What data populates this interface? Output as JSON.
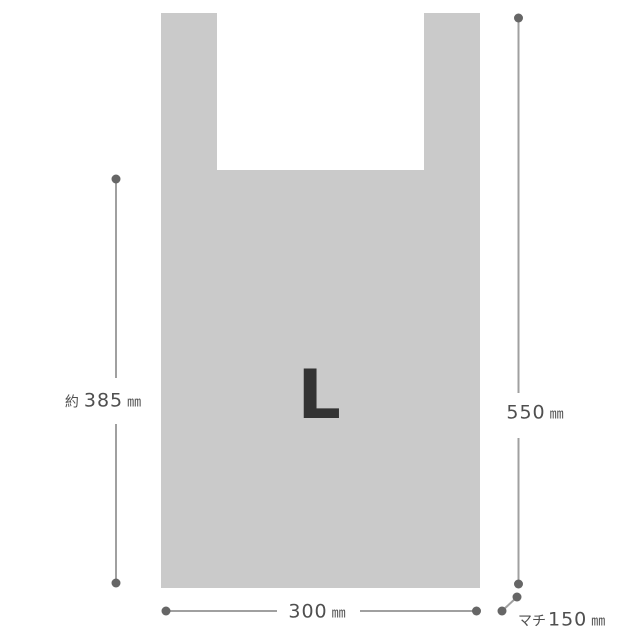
{
  "diagram": {
    "type": "product-dimension-diagram",
    "subject": "vest-type plastic shopping bag",
    "bag": {
      "size_label": "L",
      "fill_color": "#cacaca",
      "size_label_color": "#333333"
    },
    "colors": {
      "line": "#a0a0a0",
      "dot": "#666666",
      "text": "#4f4f4f",
      "background": "#ffffff"
    },
    "dimensions": {
      "left_height": {
        "prefix": "約",
        "value": "385",
        "unit": "㎜"
      },
      "right_height": {
        "value": "550",
        "unit": "㎜"
      },
      "bottom_width": {
        "value": "300",
        "unit": "㎜"
      },
      "gusset": {
        "label": "マチ",
        "value": "150",
        "unit": "㎜"
      }
    }
  }
}
